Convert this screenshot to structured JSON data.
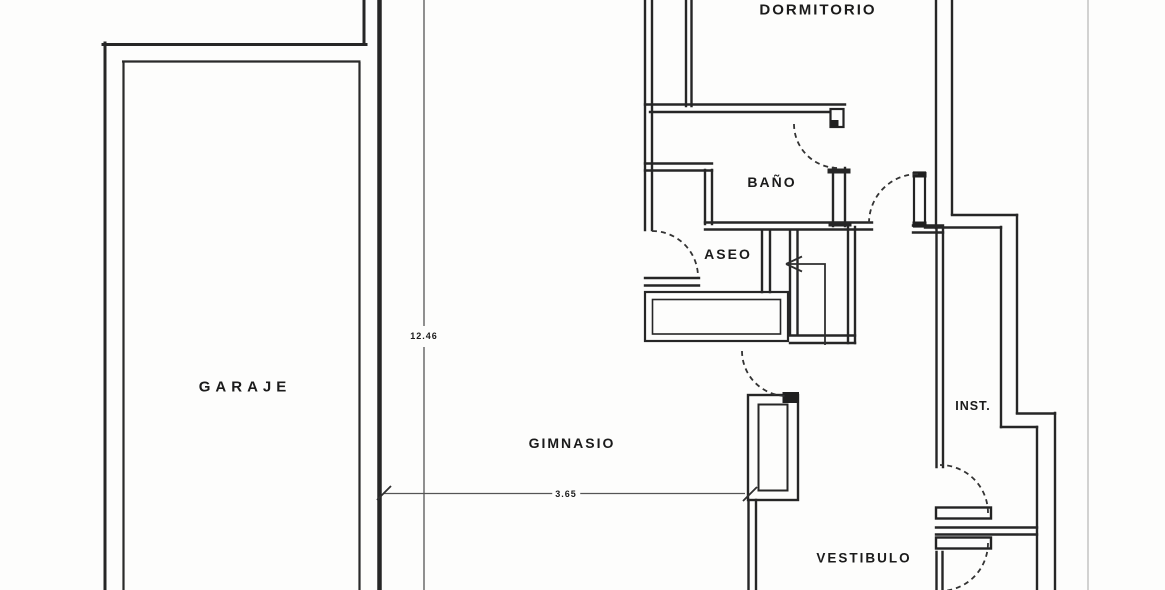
{
  "plan": {
    "title": "floor-plan-scan",
    "rooms": {
      "dormitorio": "DORMITORIO",
      "bano": "BAÑO",
      "aseo": "ASEO",
      "garaje": "GARAJE",
      "gimnasio": "GIMNASIO",
      "vestibulo": "VESTIBULO",
      "inst": "INST."
    },
    "dimensions": {
      "vertical_m": "12.46",
      "horizontal_m": "3.65"
    },
    "colors": {
      "ink": "#262626",
      "paper": "#fdfdfc",
      "faint_line": "#b5b5b5"
    }
  }
}
